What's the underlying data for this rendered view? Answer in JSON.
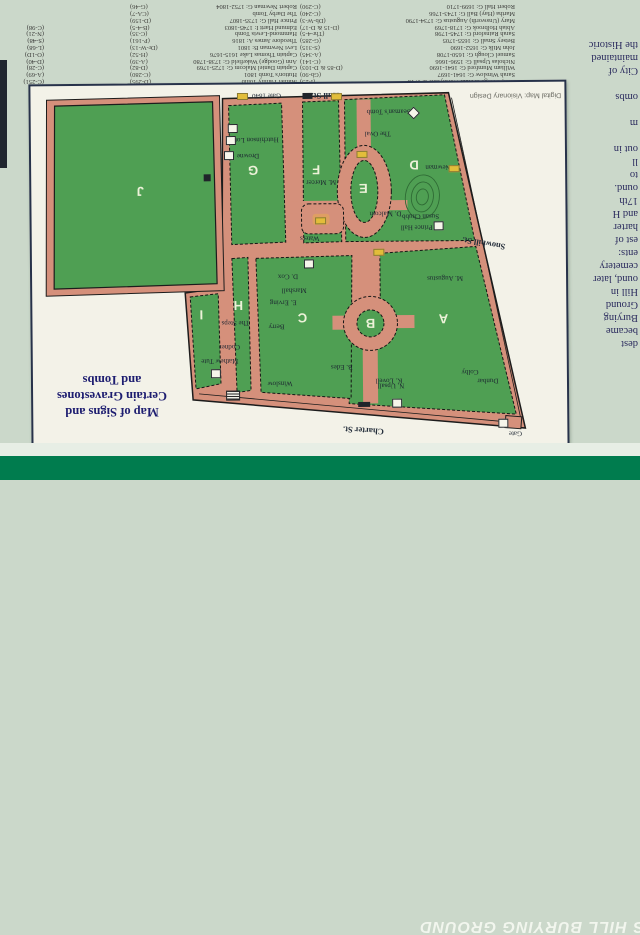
{
  "banner": {
    "visible_text": "S HILL BURYING GROUND",
    "color": "#007c4e"
  },
  "title": {
    "lines": [
      "Map of Signs and",
      "Certain Gravestones",
      "and Tombs"
    ]
  },
  "credit": "Digital Map: Visionary Design",
  "side_paragraph": {
    "lines": [
      "dest",
      "became",
      "Burying",
      "Ground",
      "Hill in",
      "ound, later",
      "cemetery",
      "ents:",
      "est of",
      "harter",
      "and H",
      "17th",
      "ound.",
      "to",
      "ll",
      "out in",
      "",
      "m",
      "",
      "ombs",
      "",
      "City of",
      "maintained",
      "the Historic"
    ]
  },
  "directory": {
    "column1": [
      {
        "n": "Ann, George & Ruth Worthylake d. 1718",
        "c": "(I-25)"
      },
      {
        "n": "Sarah Winslow G: 1641-1697",
        "c": "(Gb-90)"
      },
      {
        "n": "William Mumford G: 1641-1690",
        "c": "(D-85 & D-103)"
      },
      {
        "n": "Nicholas Upsall G: 1596-1666",
        "c": "(C-141)"
      },
      {
        "n": "Samuel Clough G: 1650-1708",
        "c": "(A-345)"
      },
      {
        "n": "John Milk G: 1652-1690",
        "c": "(S-315)"
      },
      {
        "n": "Betsey Small G: 1655-1705",
        "c": "(G-285)"
      },
      {
        "n": "Sarah Rainsford G: 1745-1798",
        "c": "(Thr-4-5)"
      },
      {
        "n": "Abiah Holbrook G: 1718-1769",
        "c": "(D-15 & D-17)"
      },
      {
        "n": "Mary (Unsworth) Augustus G: 1734-1790",
        "c": "(Db-W-3)"
      },
      {
        "n": "Martha (Hay) Ball G: 1743-1766",
        "c": "(C-240)"
      },
      {
        "n": "Robert Hall G: 1699-1710",
        "c": "(C-290)"
      }
    ],
    "column2": [
      {
        "n": "Mather Family Tomb",
        "c": "(D-295)"
      },
      {
        "n": "Hutton's Tomb 1801",
        "c": "(C-280)"
      },
      {
        "n": "Captain Daniel Malcom G: 1725-1769",
        "c": "(D-82)"
      },
      {
        "n": "Ann (Goodge) Wakefield G: 1738-1780",
        "c": "(A-39)"
      },
      {
        "n": "Captain Thomas Lake 1615-1676",
        "c": "(H-52)"
      },
      {
        "n": "Levi Newman B: 1801",
        "c": "(Dr-W-13)"
      },
      {
        "n": "Theodore James A: 1816",
        "c": "(P-161)"
      },
      {
        "n": "Hammond-Lewis Tomb",
        "c": "(C-35)"
      },
      {
        "n": "Edmund Hartt I: 1745-1803",
        "c": "(B-4-5)"
      },
      {
        "n": "Prince Hall G: 1735-1807",
        "c": "(D-159)"
      },
      {
        "n": "The Darby Tomb",
        "c": "(CA-7)"
      },
      {
        "n": "Robert Newman G: 1752-1804",
        "c": "(G-46)"
      }
    ],
    "side_codes": [
      "(C-251)",
      "(A-69)",
      "(C-28)",
      "(D-40)",
      "(O-1D)",
      "(L-68)",
      "(S-48)",
      "(N-21)",
      "(C-98)"
    ]
  },
  "map": {
    "colors": {
      "ground": "#d5907b",
      "section_green": "#4f9f53",
      "panel": "#f3f2e8",
      "sign_bg": "#cbd8ca"
    },
    "labels": [
      {
        "cls": "letter",
        "x": 441,
        "y": 318,
        "r": 180,
        "t": "A"
      },
      {
        "cls": "letter",
        "x": 368,
        "y": 322,
        "r": 180,
        "t": "B"
      },
      {
        "cls": "letter",
        "x": 300,
        "y": 316,
        "r": 180,
        "t": "C"
      },
      {
        "cls": "letter",
        "x": 413,
        "y": 164,
        "r": 180,
        "t": "D"
      },
      {
        "cls": "letter",
        "x": 362,
        "y": 187,
        "r": 180,
        "t": "E"
      },
      {
        "cls": "letter",
        "x": 315,
        "y": 168,
        "r": 180,
        "t": "F"
      },
      {
        "cls": "letter",
        "x": 252,
        "y": 168,
        "r": 180,
        "t": "G"
      },
      {
        "cls": "letter",
        "x": 236,
        "y": 303,
        "r": 180,
        "t": "H"
      },
      {
        "cls": "letter",
        "x": 199,
        "y": 312,
        "r": 180,
        "t": "I"
      },
      {
        "cls": "letter",
        "x": 139,
        "y": 188,
        "r": 180,
        "t": "J"
      },
      {
        "cls": "street",
        "x": 360,
        "y": 429,
        "r": 184,
        "t": "Charter St."
      },
      {
        "cls": "street",
        "x": 482,
        "y": 243,
        "r": 190,
        "t": "Snowhill St."
      },
      {
        "cls": "street",
        "x": 325,
        "y": 94,
        "r": 180,
        "t": "Hull St."
      },
      {
        "cls": "tiny",
        "x": 388,
        "y": 110,
        "r": 180,
        "t": "Seaman's Tomb"
      },
      {
        "cls": "tiny",
        "x": 377,
        "y": 132,
        "r": 180,
        "t": "The Oval"
      },
      {
        "cls": "tiny",
        "x": 266,
        "y": 93,
        "r": 180,
        "t": "Gate 1840"
      },
      {
        "cls": "tiny",
        "x": 256,
        "y": 137,
        "r": 180,
        "t": "Hutchinson Lot"
      },
      {
        "cls": "tiny",
        "x": 247,
        "y": 153,
        "r": 180,
        "t": "Drowne"
      },
      {
        "cls": "tiny",
        "x": 320,
        "y": 180,
        "r": 180,
        "t": "M. Mercer"
      },
      {
        "cls": "tiny",
        "x": 308,
        "y": 236,
        "r": 180,
        "t": "Waters"
      },
      {
        "cls": "tiny",
        "x": 441,
        "y": 166,
        "r": 180,
        "t": "R. Newman"
      },
      {
        "cls": "tiny",
        "x": 419,
        "y": 215,
        "r": 180,
        "t": "Susan Chubb"
      },
      {
        "cls": "tiny",
        "x": 415,
        "y": 226,
        "r": 180,
        "t": "Prince Hall"
      },
      {
        "cls": "tiny",
        "x": 384,
        "y": 212,
        "r": 180,
        "t": "D. Malcom"
      },
      {
        "cls": "tiny",
        "x": 443,
        "y": 277,
        "r": 180,
        "t": "M. Augustus"
      },
      {
        "cls": "tiny",
        "x": 286,
        "y": 274,
        "r": 180,
        "t": "D. Cox"
      },
      {
        "cls": "tiny",
        "x": 292,
        "y": 288,
        "r": 180,
        "t": "Marshall"
      },
      {
        "cls": "tiny",
        "x": 281,
        "y": 300,
        "r": 180,
        "t": "E. Erving"
      },
      {
        "cls": "tiny",
        "x": 274,
        "y": 324,
        "r": 180,
        "t": "Berry"
      },
      {
        "cls": "tiny",
        "x": 233,
        "y": 320,
        "r": 180,
        "t": "The Steps"
      },
      {
        "cls": "tiny",
        "x": 227,
        "y": 344,
        "r": 180,
        "t": "Codner"
      },
      {
        "cls": "tiny",
        "x": 217,
        "y": 358,
        "r": 180,
        "t": "Mathew Tute"
      },
      {
        "cls": "tiny",
        "x": 277,
        "y": 381,
        "r": 180,
        "t": "Winslow"
      },
      {
        "cls": "tiny",
        "x": 339,
        "y": 365,
        "r": 180,
        "t": "B. Edes"
      },
      {
        "cls": "tiny",
        "x": 386,
        "y": 379,
        "r": 180,
        "t": "K. Lovell"
      },
      {
        "cls": "tiny",
        "x": 467,
        "y": 371,
        "r": 180,
        "t": "Colby"
      },
      {
        "cls": "tiny",
        "x": 485,
        "y": 380,
        "r": 180,
        "t": "Dunbar"
      },
      {
        "cls": "tiny",
        "x": 388,
        "y": 384,
        "r": 180,
        "t": "N. Upsall"
      },
      {
        "cls": "tiny",
        "x": 512,
        "y": 433,
        "r": 180,
        "t": "Gate"
      },
      {
        "cls": "credit",
        "x": 515,
        "y": 95,
        "r": 180,
        "t": "Digital Map: Visionary Design"
      }
    ],
    "markers": [
      {
        "t": "dia",
        "x": 413,
        "y": 112,
        "name": "tomb-diamond-marker"
      },
      {
        "t": "sq",
        "x": 232,
        "y": 126,
        "name": "grave-marker"
      },
      {
        "t": "sq",
        "x": 230,
        "y": 138,
        "name": "grave-marker"
      },
      {
        "t": "sq",
        "x": 228,
        "y": 153,
        "name": "grave-marker"
      },
      {
        "t": "sq",
        "x": 437,
        "y": 225,
        "name": "grave-marker"
      },
      {
        "t": "sq",
        "x": 307,
        "y": 262,
        "name": "grave-marker"
      },
      {
        "t": "sq",
        "x": 213,
        "y": 371,
        "name": "grave-marker"
      },
      {
        "t": "sq",
        "x": 394,
        "y": 402,
        "name": "grave-marker"
      },
      {
        "t": "sq",
        "x": 500,
        "y": 423,
        "name": "gate-marker"
      },
      {
        "t": "yel",
        "x": 242,
        "y": 94,
        "name": "sign-marker"
      },
      {
        "t": "yel",
        "x": 336,
        "y": 95,
        "name": "sign-marker"
      },
      {
        "t": "yel",
        "x": 361,
        "y": 153,
        "name": "sign-marker"
      },
      {
        "t": "yel",
        "x": 453,
        "y": 168,
        "name": "sign-marker"
      },
      {
        "t": "yel",
        "x": 377,
        "y": 251,
        "name": "sign-marker"
      },
      {
        "t": "yel",
        "x": 319,
        "y": 219,
        "name": "sign-marker"
      },
      {
        "t": "dark",
        "x": 307,
        "y": 94,
        "w": 10,
        "h": 6,
        "name": "gate-bar"
      },
      {
        "t": "dark",
        "x": 361,
        "y": 403,
        "w": 12,
        "h": 5,
        "name": "gate-bar"
      },
      {
        "t": "dark",
        "x": 206,
        "y": 175,
        "w": 7,
        "h": 7,
        "name": "dark-marker"
      },
      {
        "t": "hatch",
        "x": 230,
        "y": 393,
        "name": "hatched-structure"
      }
    ]
  }
}
